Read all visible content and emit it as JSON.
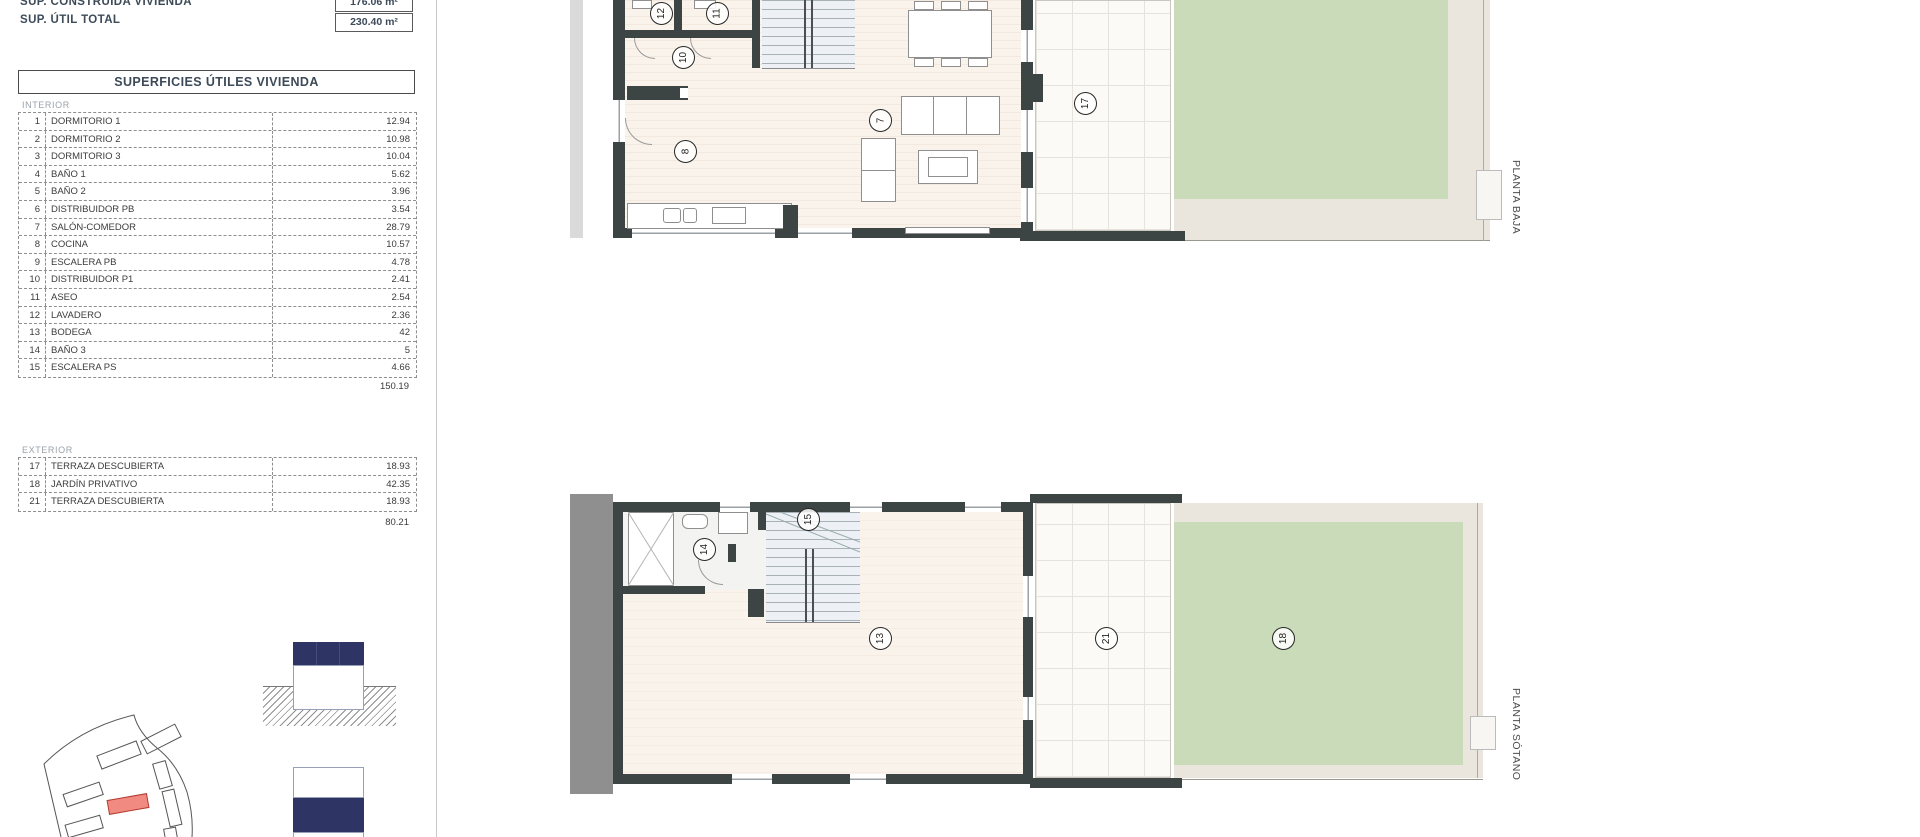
{
  "document": {
    "header": {
      "rows": [
        {
          "label": "SUP. CONSTRUIDA VIVIENDA",
          "value": "176.06 m²"
        },
        {
          "label": "SUP. ÚTIL TOTAL",
          "value": "230.40 m²"
        }
      ]
    },
    "surface_table": {
      "title": "SUPERFICIES ÚTILES VIVIENDA",
      "interior": {
        "section_label": "INTERIOR",
        "rows": [
          {
            "num": "1",
            "label": "DORMITORIO 1",
            "value": "12.94"
          },
          {
            "num": "2",
            "label": "DORMITORIO 2",
            "value": "10.98"
          },
          {
            "num": "3",
            "label": "DORMITORIO 3",
            "value": "10.04"
          },
          {
            "num": "4",
            "label": "BAÑO 1",
            "value": "5.62"
          },
          {
            "num": "5",
            "label": "BAÑO 2",
            "value": "3.96"
          },
          {
            "num": "6",
            "label": "DISTRIBUIDOR PB",
            "value": "3.54"
          },
          {
            "num": "7",
            "label": "SALÓN-COMEDOR",
            "value": "28.79"
          },
          {
            "num": "8",
            "label": "COCINA",
            "value": "10.57"
          },
          {
            "num": "9",
            "label": "ESCALERA PB",
            "value": "4.78"
          },
          {
            "num": "10",
            "label": "DISTRIBUIDOR P1",
            "value": "2.41"
          },
          {
            "num": "11",
            "label": "ASEO",
            "value": "2.54"
          },
          {
            "num": "12",
            "label": "LAVADERO",
            "value": "2.36"
          },
          {
            "num": "13",
            "label": "BODEGA",
            "value": "42"
          },
          {
            "num": "14",
            "label": "BAÑO 3",
            "value": "5"
          },
          {
            "num": "15",
            "label": "ESCALERA PS",
            "value": "4.66"
          }
        ],
        "total": "150.19"
      },
      "exterior": {
        "section_label": "EXTERIOR",
        "rows": [
          {
            "num": "17",
            "label": "TERRAZA DESCUBIERTA",
            "value": "18.93"
          },
          {
            "num": "18",
            "label": "JARDÍN PRIVATIVO",
            "value": "42.35"
          },
          {
            "num": "21",
            "label": "TERRAZA DESCUBIERTA",
            "value": "18.93"
          }
        ],
        "total": "80.21"
      }
    },
    "plans": {
      "baja": {
        "label": "PLANTA BAJA",
        "markers": {
          "m12": "12",
          "m11": "11",
          "m10": "10",
          "m8": "8",
          "m7": "7",
          "m17": "17"
        }
      },
      "sotano": {
        "label": "PLANTA SÓTANO",
        "markers": {
          "m14": "14",
          "m15": "15",
          "m13": "13",
          "m21": "21",
          "m18": "18"
        }
      }
    },
    "colors": {
      "wall": "#3d4444",
      "garden_green": "#c9dbb8",
      "gravel_beige": "#eae6dd",
      "floor_cream": "#faf3ec",
      "section_navy": "#2e3564",
      "highlight_plot_red": "#f18a80",
      "gray_strip": "#8f8f8f"
    }
  }
}
